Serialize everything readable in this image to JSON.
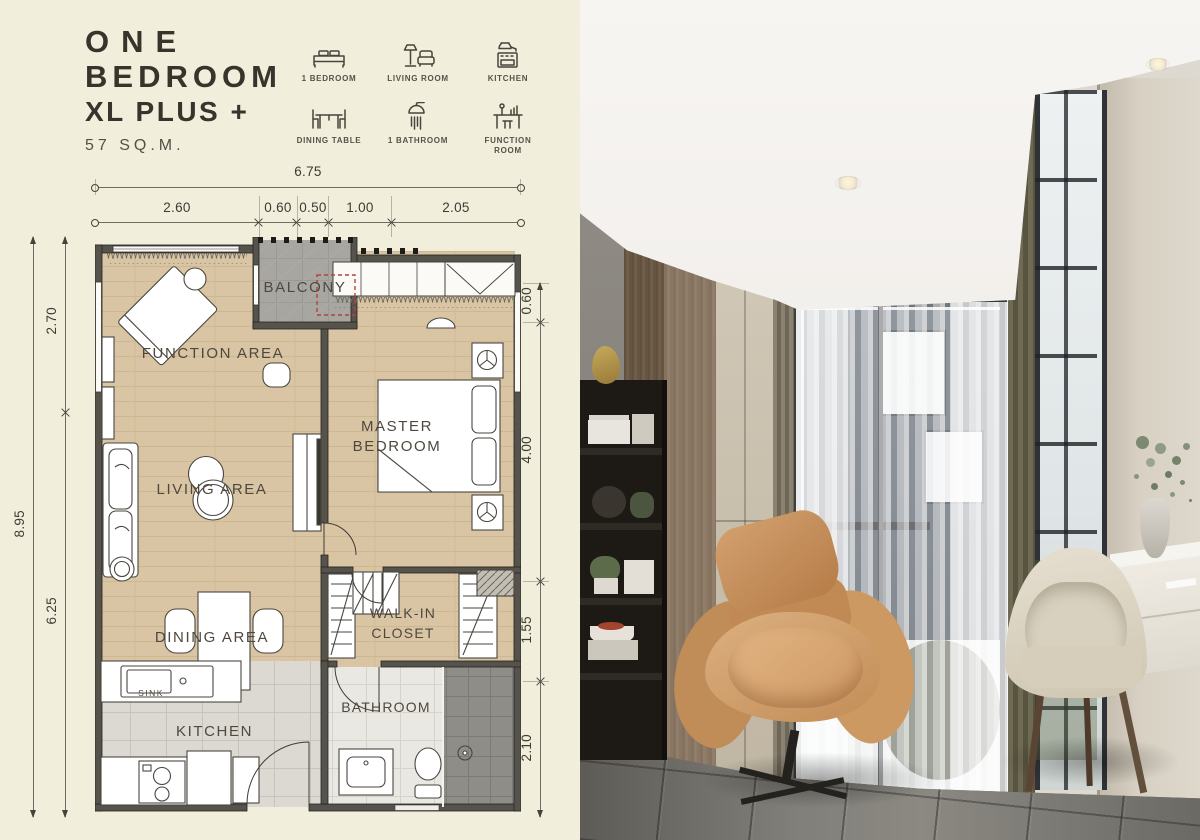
{
  "unit": {
    "title_line1": "ONE",
    "title_line2": "BEDROOM",
    "title_line3": "XL PLUS +",
    "area": "57 SQ.M."
  },
  "features": [
    {
      "icon": "bed-icon",
      "label": "1 BEDROOM"
    },
    {
      "icon": "living-room-icon",
      "label": "LIVING ROOM"
    },
    {
      "icon": "kitchen-icon",
      "label": "KITCHEN"
    },
    {
      "icon": "dining-table-icon",
      "label": "DINING TABLE"
    },
    {
      "icon": "bathroom-icon",
      "label": "1 BATHROOM"
    },
    {
      "icon": "function-room-icon",
      "label": "FUNCTION ROOM"
    }
  ],
  "dimensions": {
    "top_total": "6.75",
    "top_segments": [
      "2.60",
      "0.60",
      "0.50",
      "1.00",
      "2.05"
    ],
    "left_total": "8.95",
    "left_upper": "2.70",
    "left_lower": "6.25",
    "right_segments": [
      "0.60",
      "4.00",
      "1.55",
      "2.10"
    ]
  },
  "rooms": {
    "balcony": "BALCONY",
    "function_area": "FUNCTION AREA",
    "master_bedroom_line1": "MASTER",
    "master_bedroom_line2": "BEDROOM",
    "living_area": "LIVING AREA",
    "dining_area": "DINING AREA",
    "walk_in_closet_line1": "WALK-IN",
    "walk_in_closet_line2": "CLOSET",
    "kitchen": "KITCHEN",
    "bathroom": "BATHROOM",
    "sink": "SINK"
  },
  "colors": {
    "panel_bg": "#f2eedc",
    "ink": "#38332b",
    "wood_floor": "#d9c5a4",
    "kitchen_tile": "#dcd9d2",
    "bath_tile": "#eae8e2",
    "balcony_floor": "#a8a6a1",
    "wall": "#56534c",
    "ac_unit_red": "#b2433d"
  }
}
